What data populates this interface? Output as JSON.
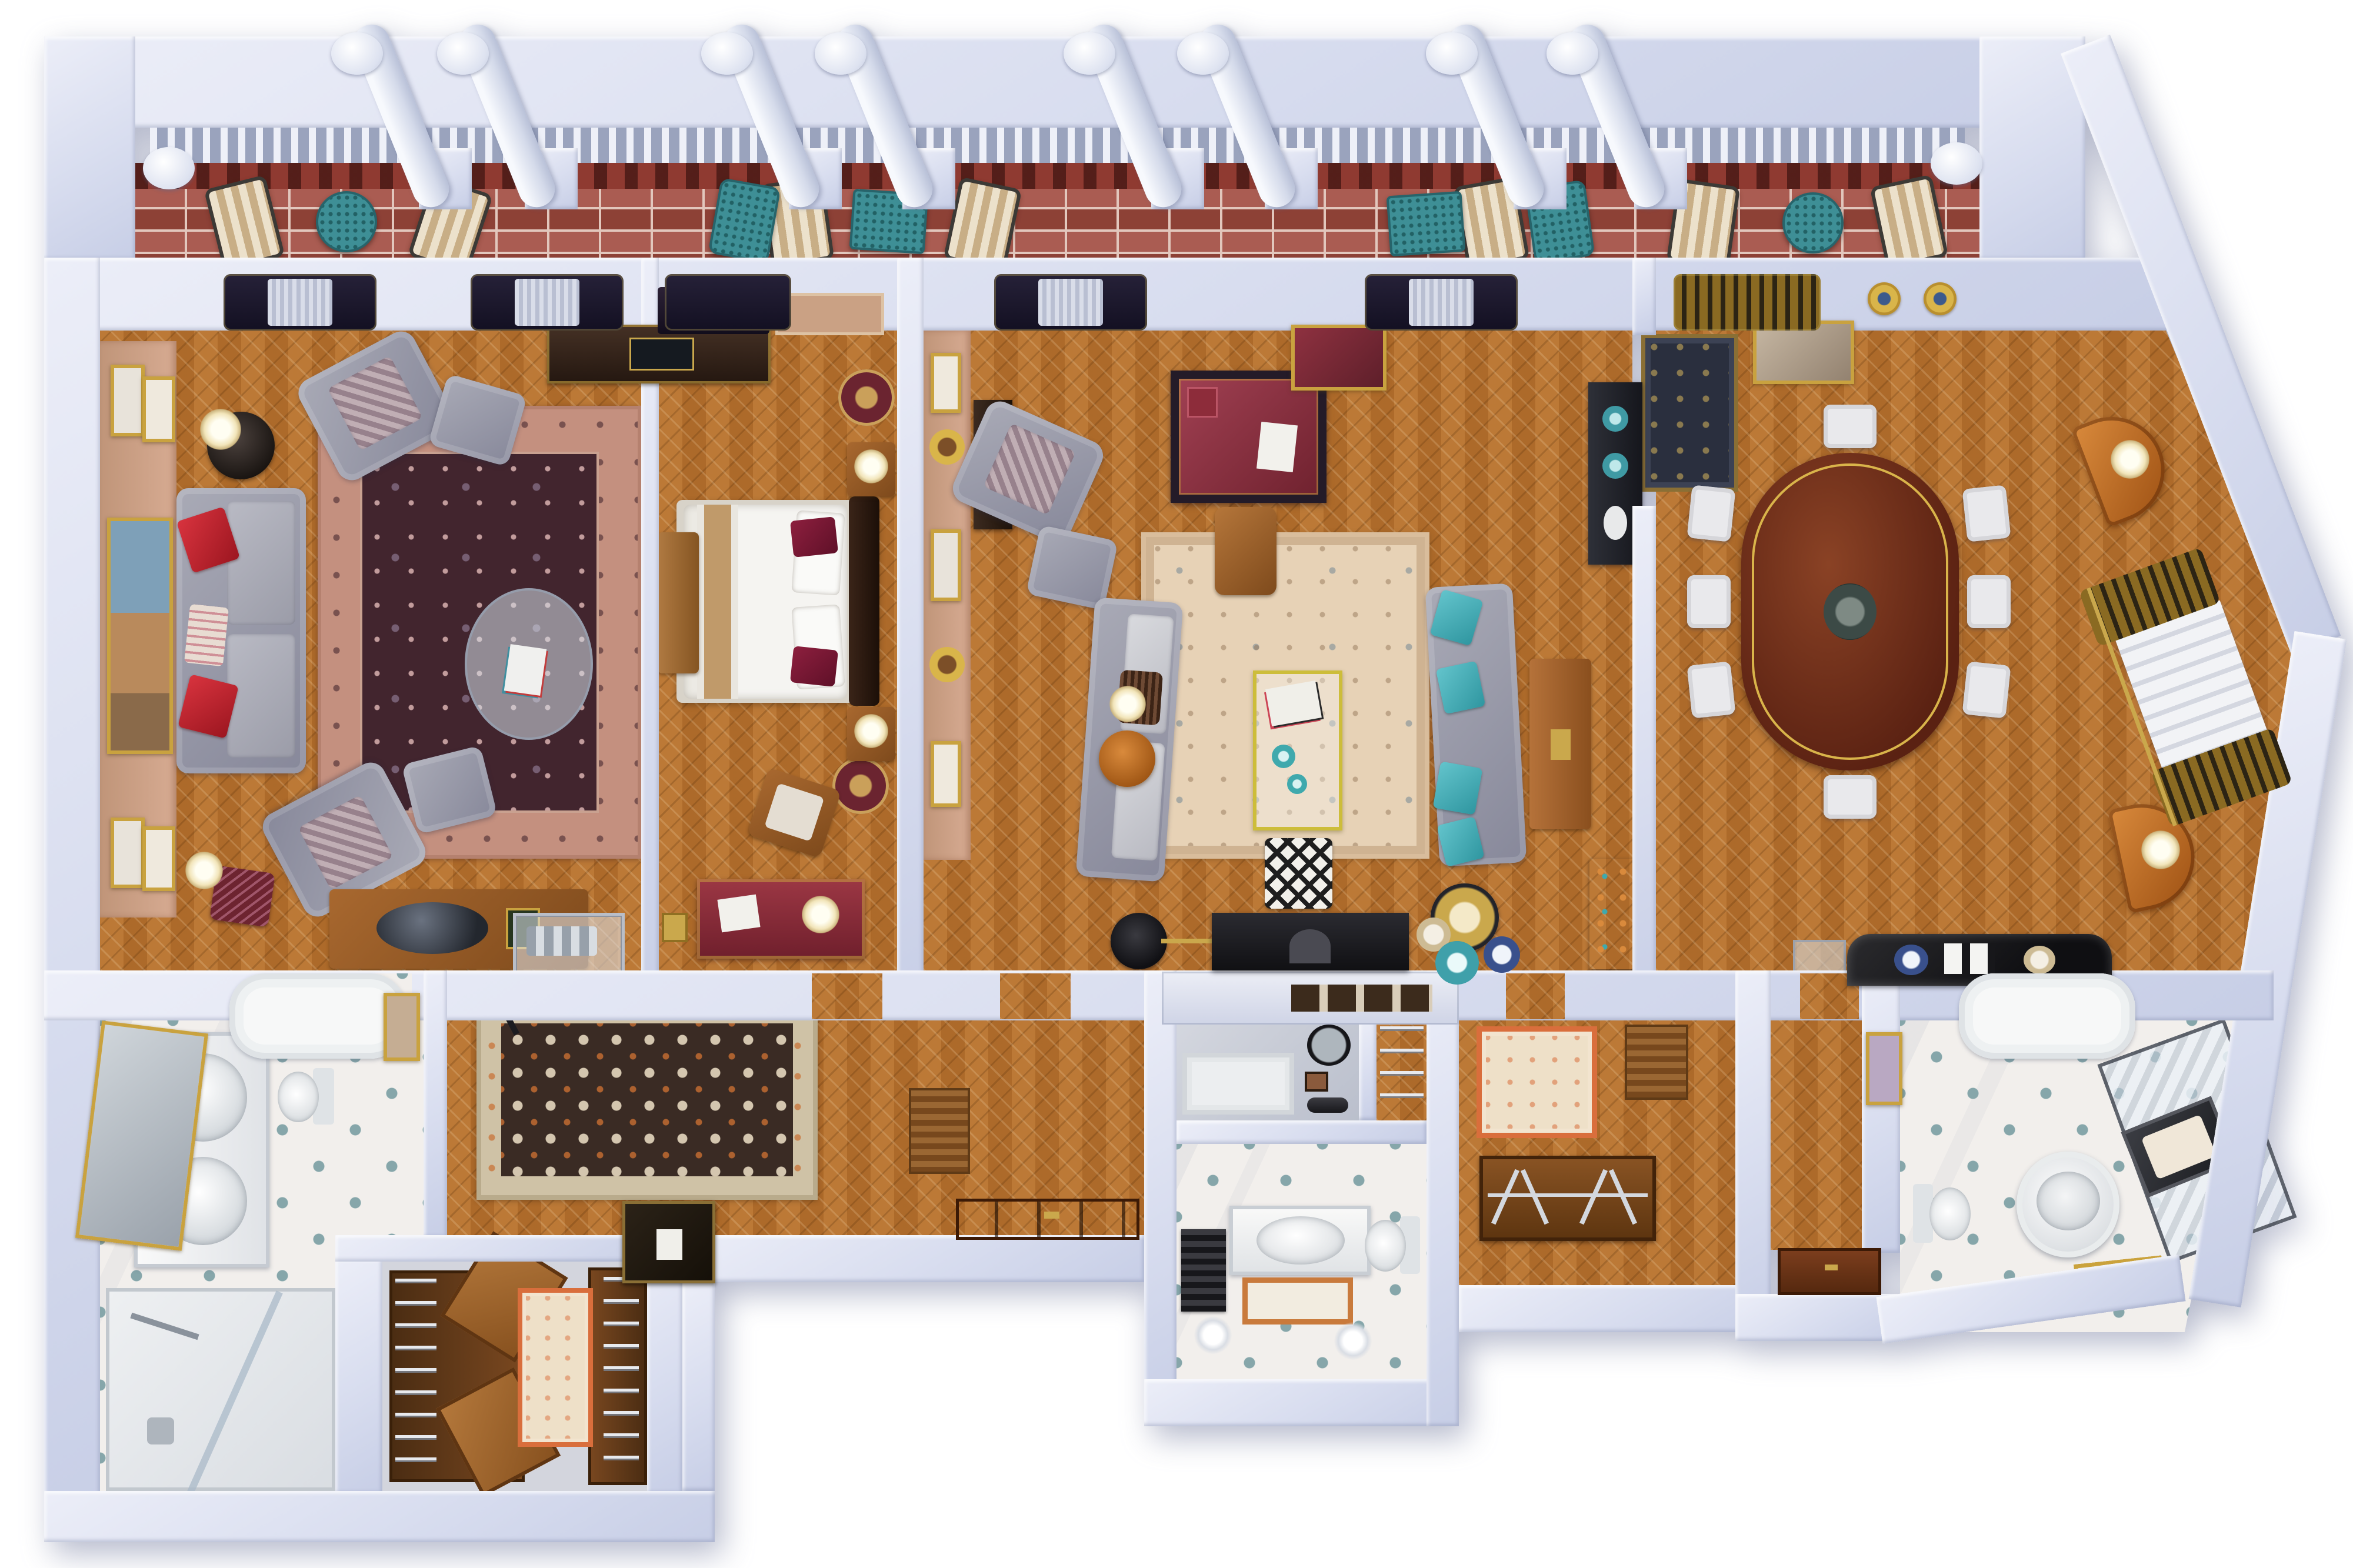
{
  "title": "3D cutaway floor plan of a luxury hotel suite",
  "view": "top-down 3D render, no visible text labels",
  "palette": {
    "wall": "#d8ddef",
    "wall-light": "#eceef8",
    "wall-edge": "#b9c1da",
    "bg": "#ffffff",
    "parquet": "#b4702e",
    "parquet-dark": "#a06023",
    "pink-wall": "#d7ab92",
    "brick": "#a04a3e",
    "brick-border": "#8f3a31",
    "mortar": "#e2c7bd",
    "rugA-border": "#c4907f",
    "rugA-field": "#42252e",
    "rugC": "#e7d2b6",
    "rugC-border": "#d9bd9c",
    "runner-border": "#cfc2a6",
    "runner-field": "#3a2b24",
    "cream-rug": "#eee0c8",
    "orange-accent": "#d96e3c",
    "marble": "#f2efec",
    "diamond": "#86a6aa",
    "sofa-gray": "#9a9ba7",
    "red": "#c2242e",
    "teal": "#49acb4",
    "bed-white": "#f5f4f1",
    "tan": "#c09a6a",
    "mahogany": "#5e2517",
    "gold": "#c9a23f",
    "chair-white": "#e9e9ec",
    "orange-cab": "#bf6728",
    "door": "#6b3418",
    "desk-red": "#8e3140",
    "brass-yellow": "#cdbd3a",
    "wood": "#9a6030",
    "dark-console": "#2c2530",
    "glass": "rgba(214,224,234,0.55)"
  },
  "terrace": {
    "name": "Roof terrace",
    "floor": "red brick",
    "features": [
      "white parapet",
      "balustrade of small balusters",
      "dentil frieze",
      "8 leaning round columns",
      "2 corner pilasters"
    ],
    "furniture": [
      "7 striped lounge chairs",
      "2 teal mesh armchairs",
      "2 round teal bistro tables",
      "2 rectangular teal mesh tables"
    ]
  },
  "rooms": {
    "livingA": {
      "name": "Sitting room",
      "furniture": [
        "ornate maroon rug with rose border",
        "gray sofa with two red pillows and floral pillow",
        "two gray armchairs with ottomans",
        "oval glass coffee table with magazines",
        "two table lamps",
        "black side table",
        "maroon footstool",
        "writing desk with black oval tray",
        "chrome drinks trolley",
        "dark wood sideboard",
        "gallery wall with five framed pictures",
        "two gilt ceiling rosettes",
        "two dark curtained windows"
      ]
    },
    "bedroom": {
      "name": "Master bedroom",
      "furniture": [
        "double bed with white duvet and tan throw",
        "dark headboard",
        "two maroon bolster pillows",
        "two nightstands with lamps",
        "two round maroon rugs",
        "foot bench",
        "leather armchair",
        "maroon dresser with gold trim",
        "dark wall shelf",
        "curtained window",
        "gold travel clock box"
      ]
    },
    "livingC": {
      "name": "Grand living room",
      "furniture": [
        "cream oriental area rug",
        "brass-yellow glass coffee table",
        "zebra-print pouf",
        "two gray sofas",
        "four teal pillows",
        "maroon leather writing desk with chair",
        "gilt wall mirror",
        "black console with teal vases",
        "picture wall with round gilt medallions",
        "dark hall console",
        "gray armchair with ottoman",
        "orange drum side table with lamp",
        "round tray table",
        "black disc floor lamp",
        "wood side console",
        "television on white media console",
        "decorative plates",
        "dark AV cabinet",
        "two dark curtained windows"
      ]
    },
    "dining": {
      "name": "Dining room",
      "furniture": [
        "oval mahogany dining table with gold inlay",
        "dark centerpiece bowl",
        "eight white upholstered chairs",
        "navy and gold rug",
        "two orange demilune cabinets with lamps",
        "bay window with roman shade and gold curtains",
        "gilt framed mirror",
        "two gilt ceiling rosettes",
        "black marble console",
        "glass magazine stand",
        "gold curtained windows"
      ]
    },
    "bathLeft": {
      "name": "Master bathroom",
      "furniture": [
        "marble floor with teal diamond inlay",
        "bathtub",
        "double vanity with two round basins",
        "leaning gold framed mirror",
        "toilet",
        "walk-in shower with glass screen"
      ]
    },
    "closet": {
      "name": "Walk-in wardrobe",
      "furniture": [
        "two wood wardrobes with open doors",
        "wire shelving",
        "cream rug with orange border"
      ]
    },
    "hall": {
      "name": "Entrance hall",
      "furniture": [
        "ornate runner rug",
        "black folding luggage rack",
        "dark chest with tissue box",
        "gold framed pictures",
        "wood slat screen",
        "paneled entry door"
      ]
    },
    "utility": {
      "name": "Shower room",
      "furniture": [
        "shower tray",
        "round black framed mirror",
        "framed prints",
        "towel holder"
      ]
    },
    "linen": {
      "name": "Linen closet",
      "furniture": [
        "chrome wire shelving"
      ]
    },
    "powder": {
      "name": "Guest bathroom",
      "furniture": [
        "marble vanity with oval basin",
        "orange framed bath mat",
        "toilet",
        "slatted bench",
        "two round sconce lamps"
      ]
    },
    "dressing": {
      "name": "Dressing room",
      "furniture": [
        "cream rug with orange border",
        "wood slat screen",
        "luggage bench with chrome cross legs",
        "service door"
      ]
    },
    "bathRight": {
      "name": "Second bathroom",
      "furniture": [
        "bathtub",
        "angled glass shower",
        "round scalloped vanity basin",
        "toilet",
        "towel bench with mat",
        "small framed mat",
        "gilt framed picture"
      ]
    }
  }
}
